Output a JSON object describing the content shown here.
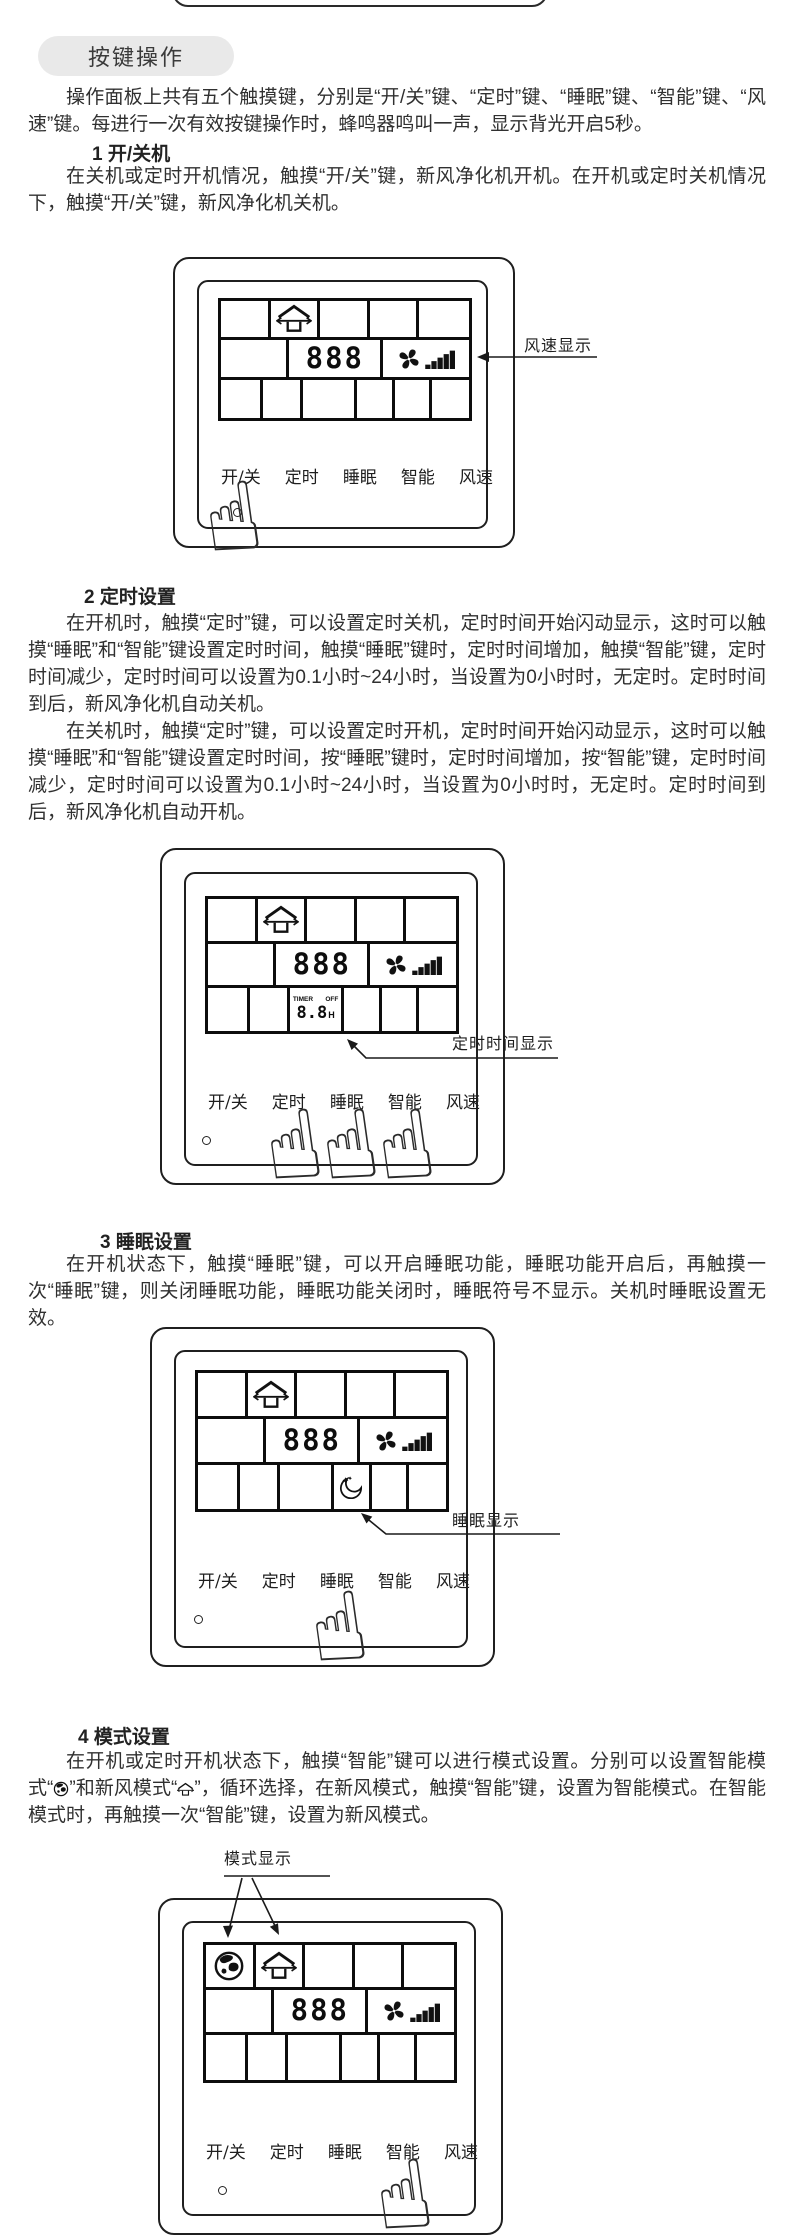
{
  "header": {
    "title": "按键操作"
  },
  "intro": "操作面板上共有五个触摸键，分别是“开/关”键、“定时”键、“睡眠”键、“智能”键、“风速”键。每进行一次有效按键操作时，蜂鸣器鸣叫一声，显示背光开启5秒。",
  "sections": [
    {
      "heading": "1 开/关机",
      "p1": "在关机或定时开机情况，触摸“开/关”键，新风净化机开机。在开机或定时关机情况下，触摸“开/关”键，新风净化机关机。"
    },
    {
      "heading": "2 定时设置",
      "p1": "在开机时，触摸“定时”键，可以设置定时关机，定时时间开始闪动显示，这时可以触摸“睡眠”和“智能”键设置定时时间，触摸“睡眠”键时，定时时间增加，触摸“智能”键，定时时间减少，定时时间可以设置为0.1小时~24小时，当设置为0小时时，无定时。定时时间到后，新风净化机自动关机。",
      "p2": "在关机时，触摸“定时”键，可以设置定时开机，定时时间开始闪动显示，这时可以触摸“睡眠”和“智能”键设置定时时间，按“睡眠”键时，定时时间增加，按“智能”键，定时时间减少，定时时间可以设置为0.1小时~24小时，当设置为0小时时，无定时。定时时间到后，新风净化机自动开机。"
    },
    {
      "heading": "3 睡眠设置",
      "p1": "在开机状态下，触摸“睡眠”键，可以开启睡眠功能，睡眠功能开启后，再触摸一次“睡眠”键，则关闭睡眠功能，睡眠功能关闭时，睡眠符号不显示。关机时睡眠设置无效。"
    },
    {
      "heading": "4 模式设置"
    }
  ],
  "mode_text": {
    "part1": "在开机或定时开机状态下，触摸“智能”键可以进行模式设置。分别可以设置智能模式“",
    "part2": "”和新风模式“",
    "part3": "”，循环选择，在新风模式，触摸“智能”键，设置为智能模式。在智能模式时，再触摸一次“智能”键，设置为新风模式。"
  },
  "panel": {
    "buttons": [
      "开/关",
      "定时",
      "睡眠",
      "智能",
      "风速"
    ],
    "digits": "888",
    "timer": {
      "label_timer": "TIMER",
      "label_off": "OFF",
      "value": "8.8",
      "unit": "H"
    },
    "icons": {
      "fresh_air": "house-airflow-icon",
      "smart": "globe-icon",
      "sleep": "moon-icon",
      "fan": "fan-icon",
      "speed_bars": "wind-speed-bars-icon"
    }
  },
  "callouts": {
    "fan_speed": "风速显示",
    "timer_time": "定时时间显示",
    "sleep": "睡眠显示",
    "mode": "模式显示"
  },
  "hand_glyph": "☝"
}
